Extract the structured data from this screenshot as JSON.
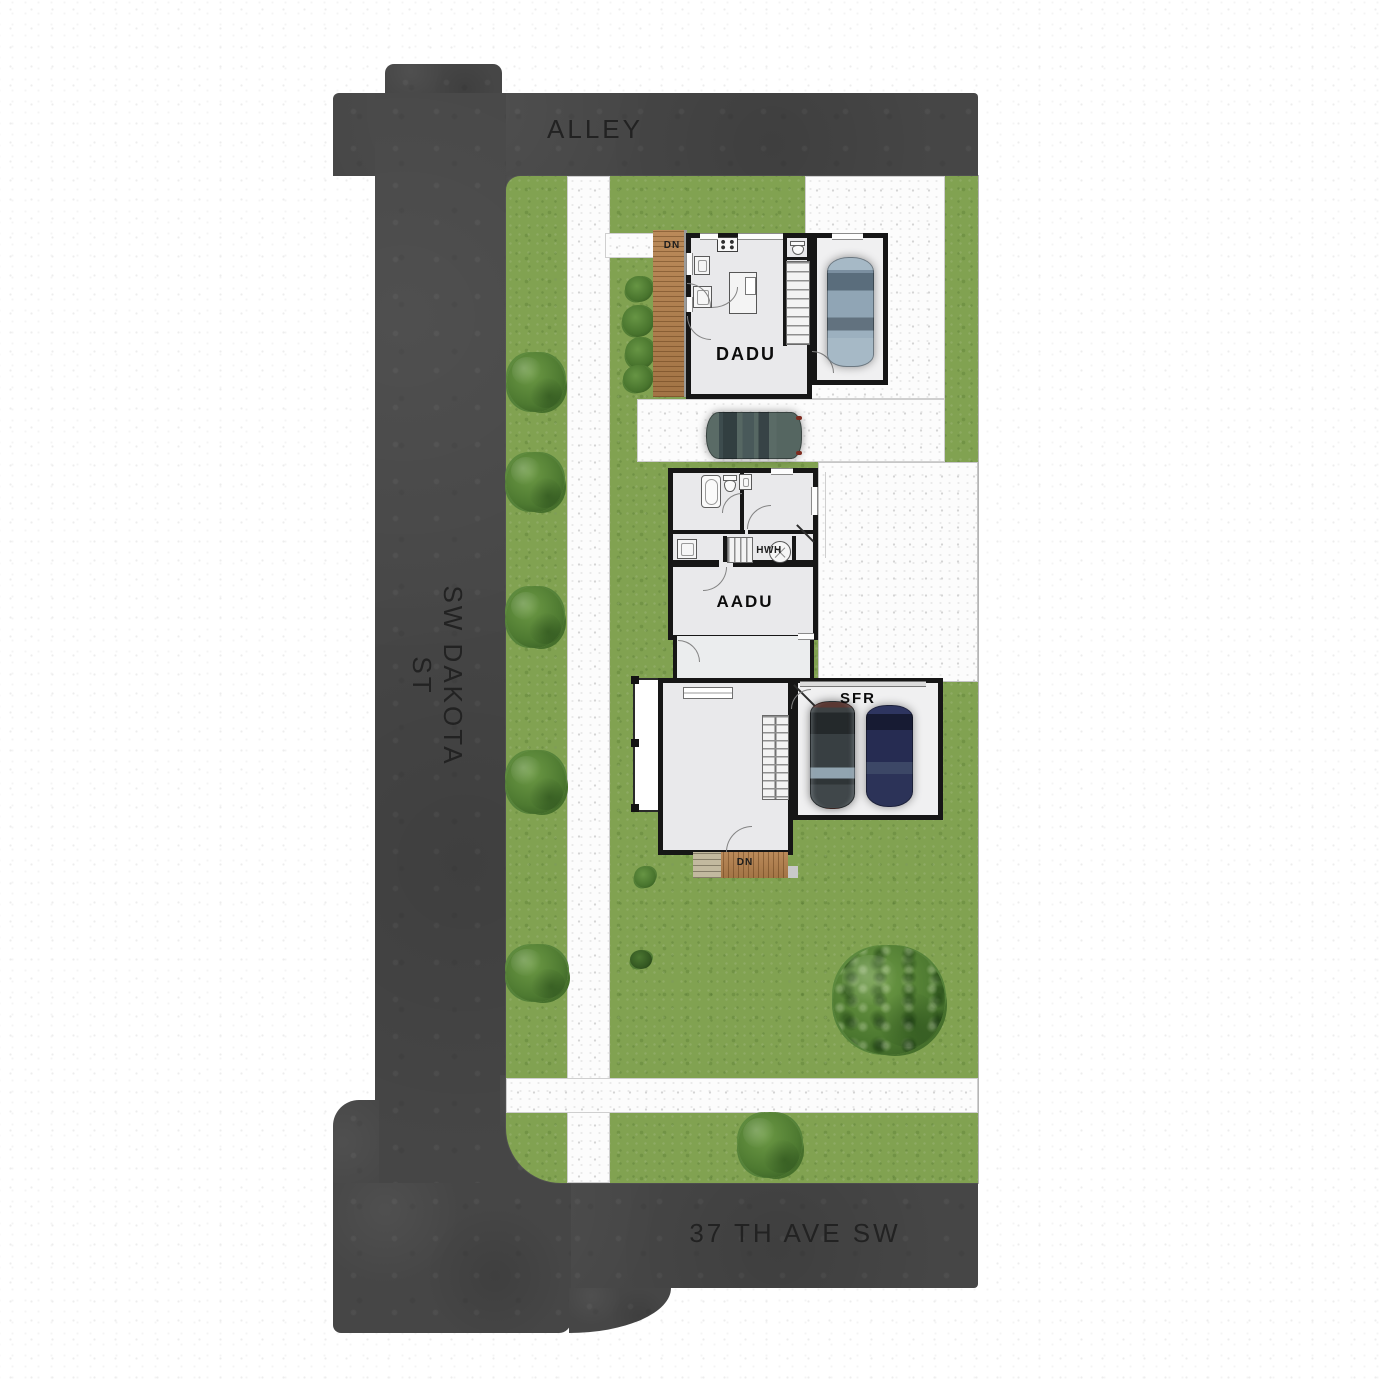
{
  "plan": {
    "streets": {
      "alley": "ALLEY",
      "dakota": "SW DAKOTA ST",
      "ave37": "37 TH AVE SW"
    },
    "units": {
      "dadu": {
        "label": "DADU",
        "deck_note": "DN"
      },
      "aadu": {
        "label": "AADU",
        "water_heater": "HWH"
      },
      "sfr": {
        "label": "SFR",
        "deck_note": "DN"
      }
    },
    "colors": {
      "road": "#464646",
      "grass": "#81a251",
      "concrete": "#fcfcfc",
      "deck_wood": "#b5814d",
      "wall": "#161616",
      "floor": "#e9e9eb",
      "label_text": "#1c1c1c"
    }
  }
}
